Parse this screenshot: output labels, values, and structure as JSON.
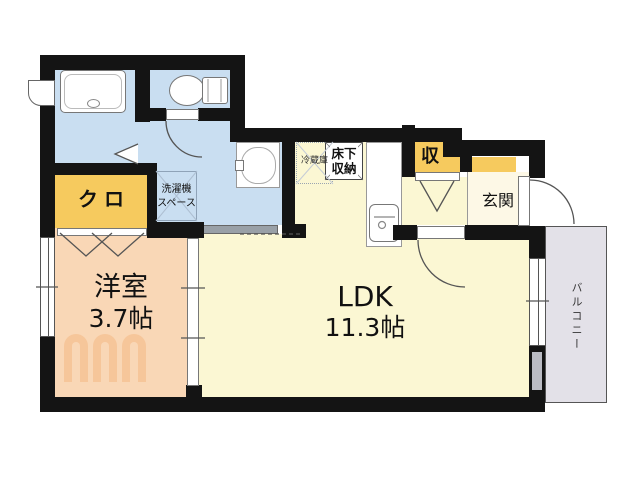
{
  "colors": {
    "wall": "#141414",
    "wet-area": "#c9def1",
    "closet-yellow": "#f6ca5e",
    "room-peach": "#f9d7b6",
    "ldk-cream": "#fbf7d3",
    "entrance-cream": "#fdf8e6",
    "balcony-gray": "#e3e1e8",
    "fixture-line": "#888888",
    "watermark": "#f08b3a"
  },
  "rooms": {
    "western": {
      "name": "洋室",
      "size": "3.7帖"
    },
    "ldk": {
      "name": "LDK",
      "size": "11.3帖"
    },
    "closet": {
      "name": "クロ"
    },
    "laundry": {
      "line1": "洗濯機",
      "line2": "スペース"
    },
    "refrigerator": {
      "name": "冷蔵庫"
    },
    "underfloor_storage": {
      "line1": "床下",
      "line2": "収納"
    },
    "storage": {
      "name": "収"
    },
    "entrance": {
      "name": "玄関"
    },
    "balcony": {
      "name": "バルコニー"
    }
  }
}
